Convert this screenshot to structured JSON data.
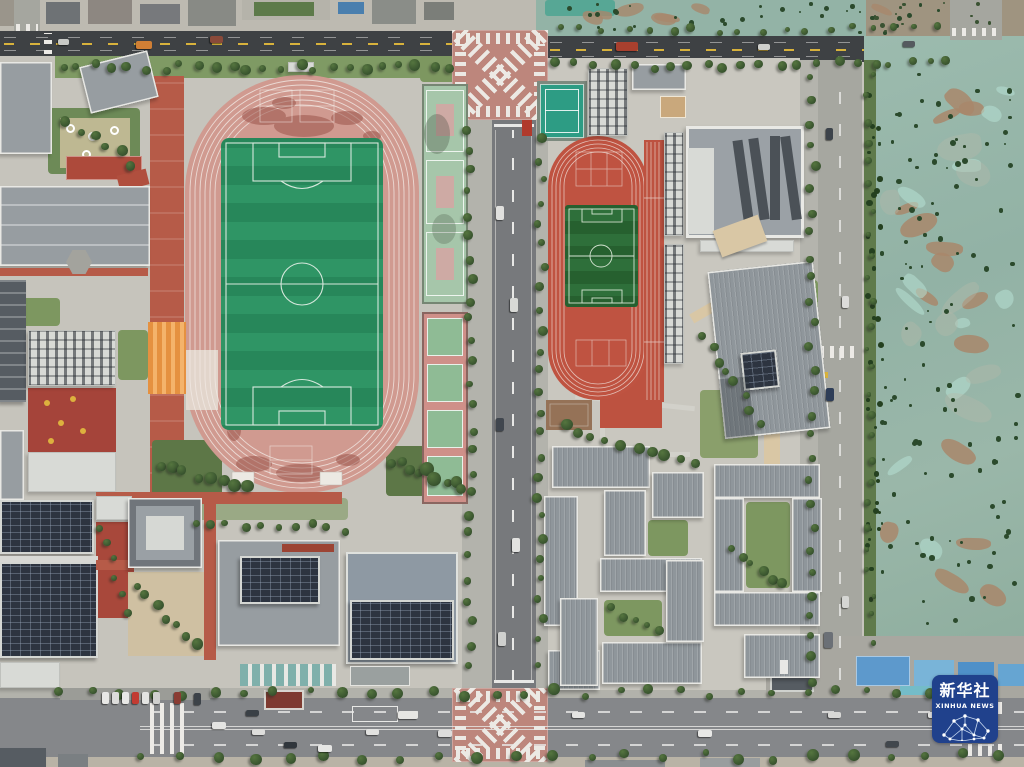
{
  "watermark": {
    "brand_cn": "新华社",
    "brand_en": "XINHUA NEWS",
    "background_color": "#20418c",
    "text_color": "#ffffff"
  },
  "palette": {
    "large_track_pink": "#d09a90",
    "large_field_green": "#2f9565",
    "small_track_red": "#bf5341",
    "small_field_green": "#2e6f3a",
    "asphalt_dark_road": "#3e4144",
    "asphalt_city_road": "#85878a",
    "concrete_road": "#a6a7a0",
    "vacant_lot_teal": "#96b6a9",
    "vacant_lot_dirt_brown": "#a8876b",
    "roof_grey": "#979da1",
    "solar_panel_dark": "#2d3440",
    "terracotta_path": "#b65b48",
    "tan_walkway": "#d9c7a5",
    "tennis_court_teal": "#2d9c84",
    "construction_shed_blue": "#5d99cc"
  }
}
